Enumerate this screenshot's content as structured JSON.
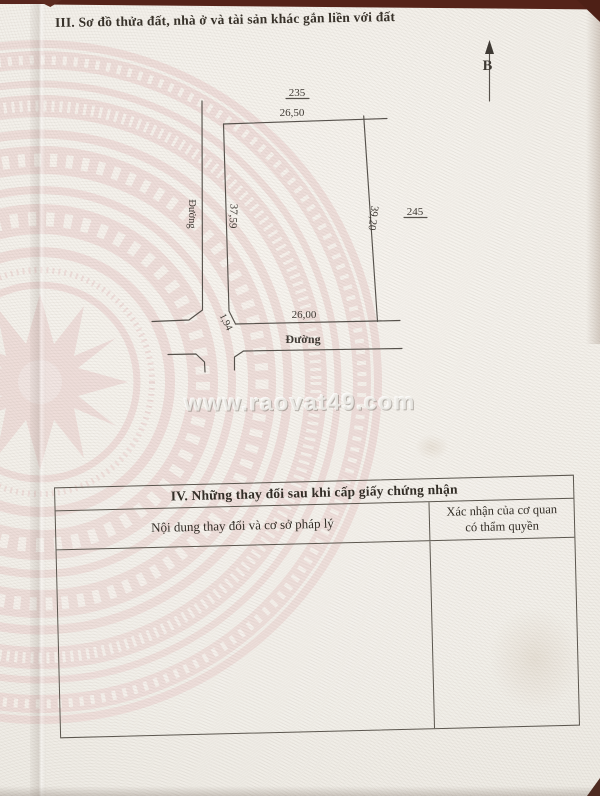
{
  "header": {
    "section_title": "III. Sơ đồ thửa đất, nhà ở và tài sản khác gắn liền với đất"
  },
  "compass": {
    "north_label": "B"
  },
  "plot_diagram": {
    "adjacent_parcel_top": "235",
    "adjacent_parcel_right": "245",
    "edge_top_length": "26,50",
    "edge_left_length": "37,59",
    "edge_right_length": "39,20",
    "edge_bottom_length": "26,00",
    "edge_corner_length": "1,94",
    "road_left_label": "Đường",
    "road_bottom_label": "Đường"
  },
  "watermark": {
    "text": "www.raovat49.com"
  },
  "changes_table": {
    "title": "IV. Những thay đổi sau khi cấp giấy chứng nhận",
    "col1_header": "Nội dung thay đổi và cơ sở pháp lý",
    "col2_header_line1": "Xác nhận của cơ quan",
    "col2_header_line2": "có thẩm quyền"
  },
  "colors": {
    "background_maroon": "#552319",
    "paper": "#f2efe9",
    "pattern_pink": "#ecd7d4",
    "ink": "#3e3933"
  }
}
